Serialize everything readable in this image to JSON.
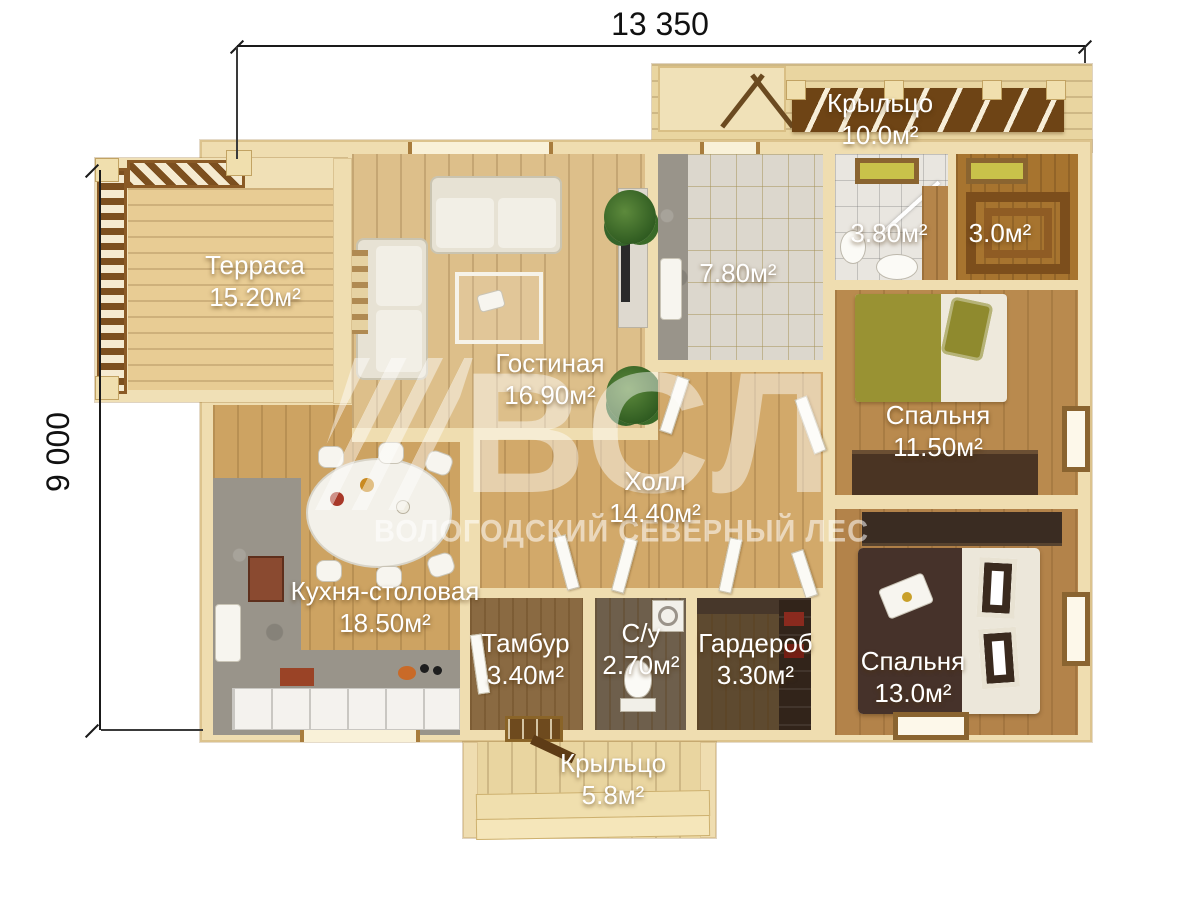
{
  "dimensions": {
    "width_label": "13 350",
    "height_label": "9 000"
  },
  "watermark": {
    "logo_text": "ВСЛ",
    "subtitle": "ВОЛОГОДСКИЙ СЕВЕРНЫЙ ЛЕС"
  },
  "rooms": [
    {
      "name": "Терраса",
      "area": "15.20м²"
    },
    {
      "name": "Гостиная",
      "area": "16.90м²"
    },
    {
      "name": "Крыльцо",
      "area": "10.0м²"
    },
    {
      "name": "",
      "area": "7.80м²"
    },
    {
      "name": "",
      "area": "3.80м²"
    },
    {
      "name": "",
      "area": "3.0м²"
    },
    {
      "name": "Спальня",
      "area": "11.50м²"
    },
    {
      "name": "Холл",
      "area": "14.40м²"
    },
    {
      "name": "Кухня-столовая",
      "area": "18.50м²"
    },
    {
      "name": "Тамбур",
      "area": "3.40м²"
    },
    {
      "name": "С/у",
      "area": "2.70м²"
    },
    {
      "name": "Гардероб",
      "area": "3.30м²"
    },
    {
      "name": "Спальня",
      "area": "13.0м²"
    },
    {
      "name": "Крыльцо",
      "area": "5.8м²"
    }
  ],
  "colors": {
    "wall": "#efddb0",
    "terrace_wood": "#e8cc94",
    "living_wood": "#ddbf8a",
    "kitchen_wood": "#cda362",
    "bedroom_wood": "#b98a4e",
    "bed_olive": "#999233",
    "bed_dark_brown": "#46322a",
    "label_text": "#ffffff",
    "dimension_text": "#1a1a1a"
  }
}
